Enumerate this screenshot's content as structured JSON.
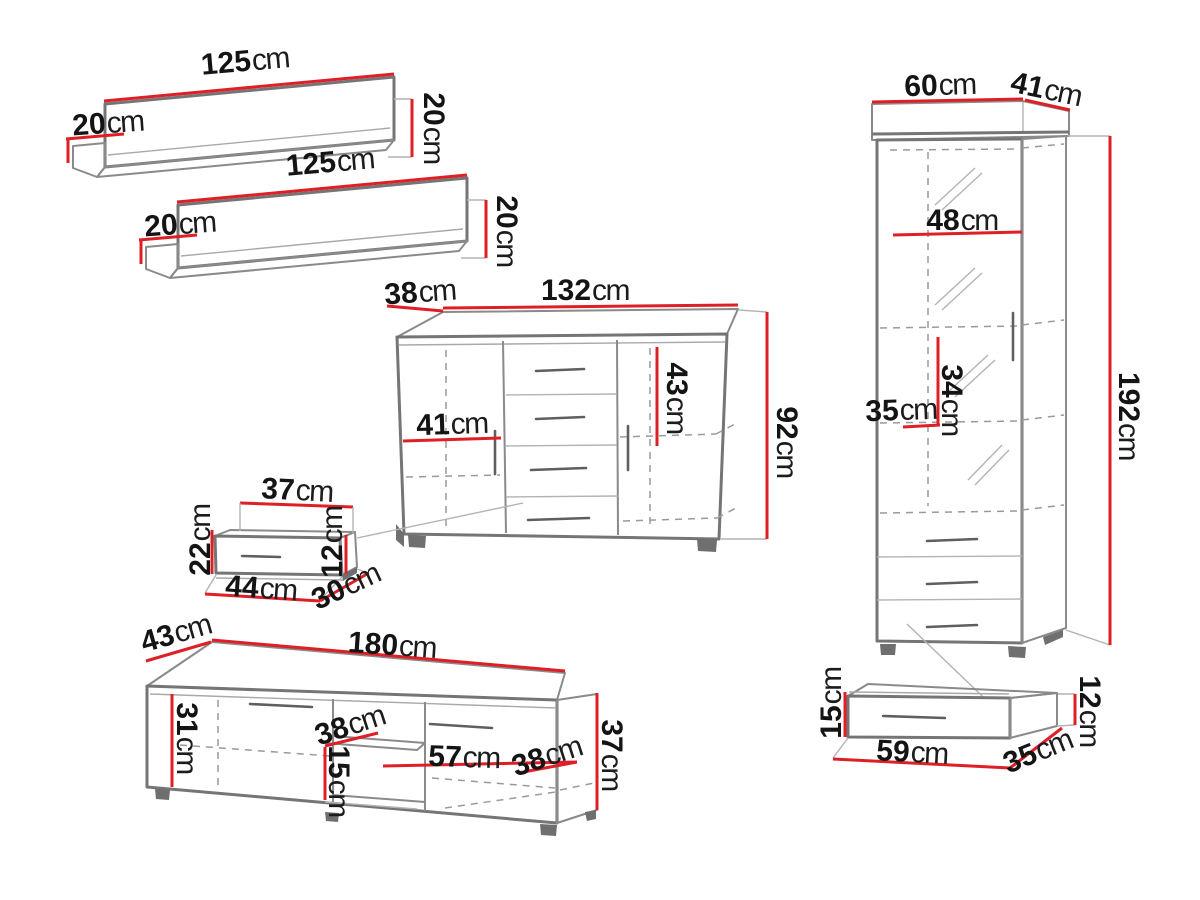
{
  "diagram_title": "furniture wall unit dimension diagram",
  "colors": {
    "dimension_line": "#de1f26",
    "furniture_line": "#757575",
    "hidden_line": "#9a9a9a",
    "label_text": "#141414",
    "background": "#ffffff"
  },
  "furniture": {
    "wall_shelf_1": {
      "name": "wall shelf 1",
      "width": {
        "value": "125",
        "unit": "cm"
      },
      "depth": {
        "value": "20",
        "unit": "cm"
      },
      "height": {
        "value": "20",
        "unit": "cm"
      }
    },
    "wall_shelf_2": {
      "name": "wall shelf 2",
      "width": {
        "value": "125",
        "unit": "cm"
      },
      "depth": {
        "value": "20",
        "unit": "cm"
      },
      "height": {
        "value": "20",
        "unit": "cm"
      }
    },
    "sideboard": {
      "name": "sideboard",
      "width": {
        "value": "132",
        "unit": "cm"
      },
      "depth": {
        "value": "38",
        "unit": "cm"
      },
      "height": {
        "value": "92",
        "unit": "cm"
      },
      "inner_width": {
        "value": "41",
        "unit": "cm"
      },
      "inner_height": {
        "value": "43",
        "unit": "cm"
      }
    },
    "wall_box": {
      "name": "hanging drawer box",
      "top_width": {
        "value": "37",
        "unit": "cm"
      },
      "left_height": {
        "value": "22",
        "unit": "cm"
      },
      "right_height": {
        "value": "12",
        "unit": "cm"
      },
      "bottom_width": {
        "value": "44",
        "unit": "cm"
      },
      "depth": {
        "value": "30",
        "unit": "cm"
      }
    },
    "display_cabinet": {
      "name": "tall display cabinet",
      "width": {
        "value": "60",
        "unit": "cm"
      },
      "depth": {
        "value": "41",
        "unit": "cm"
      },
      "height": {
        "value": "192",
        "unit": "cm"
      },
      "inner_width": {
        "value": "48",
        "unit": "cm"
      },
      "inner_height": {
        "value": "34",
        "unit": "cm"
      },
      "inner_depth": {
        "value": "35",
        "unit": "cm"
      }
    },
    "tv_stand": {
      "name": "TV stand",
      "width": {
        "value": "180",
        "unit": "cm"
      },
      "depth": {
        "value": "43",
        "unit": "cm"
      },
      "height": {
        "value": "37",
        "unit": "cm"
      },
      "left_inner_height": {
        "value": "31",
        "unit": "cm"
      },
      "shelf_width": {
        "value": "38",
        "unit": "cm"
      },
      "shelf_gap_height": {
        "value": "15",
        "unit": "cm"
      },
      "right_door_width": {
        "value": "57",
        "unit": "cm"
      },
      "right_depth": {
        "value": "38",
        "unit": "cm"
      }
    },
    "drawer": {
      "name": "under-cabinet drawer",
      "front_height": {
        "value": "15",
        "unit": "cm"
      },
      "width": {
        "value": "59",
        "unit": "cm"
      },
      "depth": {
        "value": "35",
        "unit": "cm"
      },
      "right_height": {
        "value": "12",
        "unit": "cm"
      }
    }
  }
}
